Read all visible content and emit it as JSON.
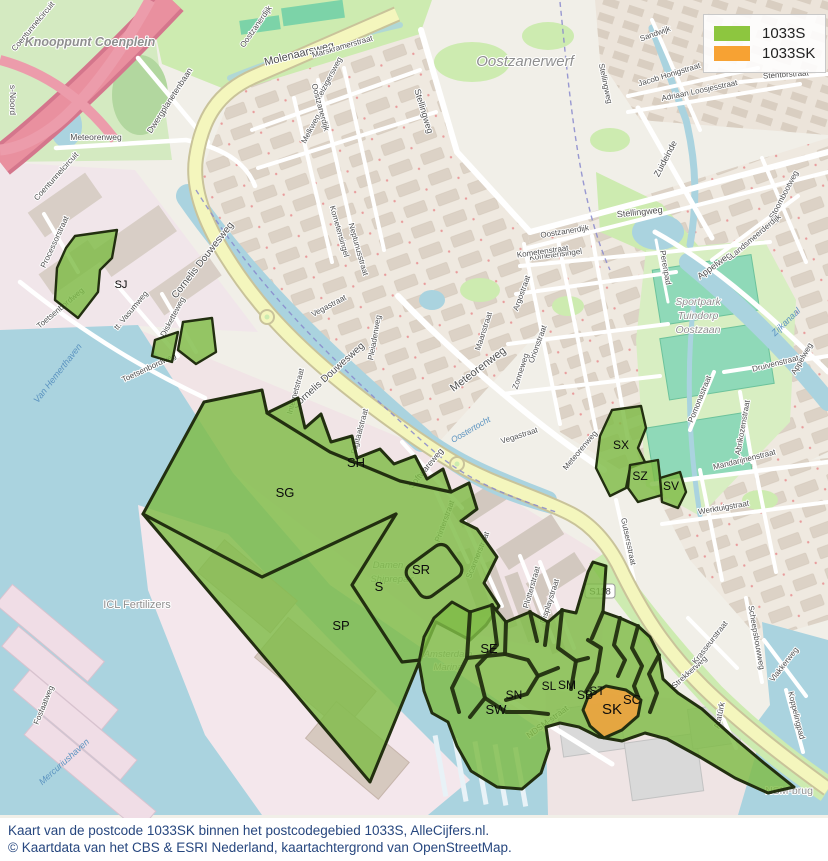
{
  "legend": {
    "items": [
      {
        "label": "1033S",
        "color": "#8dc63f"
      },
      {
        "label": "1033SK",
        "color": "#f7a233"
      }
    ]
  },
  "caption": {
    "line1": "Kaart van de postcode 1033SK binnen het postcodegebied 1033S, AlleCijfers.nl.",
    "line2": "© Kaartdata van het CBS & ESRI Nederland, kaartachtergrond van OpenStreetMap."
  },
  "map": {
    "colors": {
      "green": "#7fbc47",
      "orange": "#eda43f",
      "outline": "#222f10",
      "water": "#aad3df"
    },
    "shield": {
      "text": "S118"
    },
    "region_labels": [
      {
        "t": "SJ",
        "x": 121,
        "y": 288,
        "s": 11
      },
      {
        "t": "SG",
        "x": 285,
        "y": 497,
        "s": 13
      },
      {
        "t": "SH",
        "x": 356,
        "y": 467,
        "s": 13
      },
      {
        "t": "SP",
        "x": 341,
        "y": 630,
        "s": 13
      },
      {
        "t": "S",
        "x": 379,
        "y": 591,
        "s": 13
      },
      {
        "t": "SR",
        "x": 421,
        "y": 574,
        "s": 13
      },
      {
        "t": "SE",
        "x": 489,
        "y": 653,
        "s": 13
      },
      {
        "t": "SN",
        "x": 514,
        "y": 699,
        "s": 12
      },
      {
        "t": "SW",
        "x": 496,
        "y": 714,
        "s": 13
      },
      {
        "t": "SL",
        "x": 549,
        "y": 690,
        "s": 12
      },
      {
        "t": "SM",
        "x": 567,
        "y": 689,
        "s": 12
      },
      {
        "t": "SB",
        "x": 585,
        "y": 699,
        "s": 12
      },
      {
        "t": "ST",
        "x": 597,
        "y": 695,
        "s": 12
      },
      {
        "t": "SK",
        "x": 612,
        "y": 714,
        "s": 15
      },
      {
        "t": "SC",
        "x": 632,
        "y": 704,
        "s": 13
      },
      {
        "t": "SX",
        "x": 621,
        "y": 449,
        "s": 12
      },
      {
        "t": "SZ",
        "x": 640,
        "y": 480,
        "s": 12
      },
      {
        "t": "SV",
        "x": 671,
        "y": 490,
        "s": 12
      }
    ],
    "street_labels": [
      {
        "t": "Molenaarsweg",
        "x": 300,
        "y": 57,
        "r": -14,
        "s": 11
      },
      {
        "t": "Marskramerstraat",
        "x": 343,
        "y": 49,
        "r": -16,
        "s": 8
      },
      {
        "t": "Reizigersweg",
        "x": 331,
        "y": 80,
        "r": -62,
        "s": 8
      },
      {
        "t": "Melkweg",
        "x": 313,
        "y": 130,
        "r": -62,
        "s": 8
      },
      {
        "t": "Oostzanerdijk",
        "x": 258,
        "y": 28,
        "r": -55,
        "s": 8
      },
      {
        "t": "Oostzanerdijk",
        "x": 318,
        "y": 108,
        "r": 75,
        "s": 8
      },
      {
        "t": "Oostzanerdijk",
        "x": 565,
        "y": 234,
        "r": -9,
        "s": 8
      },
      {
        "t": "Stellingweg",
        "x": 421,
        "y": 112,
        "r": 73,
        "s": 9
      },
      {
        "t": "Stellingweg",
        "x": 640,
        "y": 215,
        "r": -6,
        "s": 9
      },
      {
        "t": "Stellingweg",
        "x": 603,
        "y": 84,
        "r": 78,
        "s": 8
      },
      {
        "t": "Kometensingel",
        "x": 556,
        "y": 257,
        "r": -7,
        "s": 8
      },
      {
        "t": "Kometensingel",
        "x": 337,
        "y": 232,
        "r": 74,
        "s": 8
      },
      {
        "t": "Neptunusstraat",
        "x": 356,
        "y": 250,
        "r": 74,
        "s": 8
      },
      {
        "t": "Kometenstraat",
        "x": 543,
        "y": 254,
        "r": -8,
        "s": 8
      },
      {
        "t": "Argostraat",
        "x": 524,
        "y": 294,
        "r": -70,
        "s": 8
      },
      {
        "t": "Maanstraat",
        "x": 486,
        "y": 332,
        "r": -72,
        "s": 8
      },
      {
        "t": "Orionstraat",
        "x": 540,
        "y": 345,
        "r": -70,
        "s": 8
      },
      {
        "t": "Zonneweg",
        "x": 523,
        "y": 372,
        "r": -72,
        "s": 8
      },
      {
        "t": "Vegastraat",
        "x": 330,
        "y": 308,
        "r": -28,
        "s": 8
      },
      {
        "t": "Vegastraat",
        "x": 520,
        "y": 438,
        "r": -18,
        "s": 8
      },
      {
        "t": "Pleiadenweg",
        "x": 377,
        "y": 338,
        "r": -80,
        "s": 8
      },
      {
        "t": "Meteorenweg",
        "x": 480,
        "y": 372,
        "r": -37,
        "s": 11
      },
      {
        "t": "Meteorenweg",
        "x": 582,
        "y": 452,
        "r": -50,
        "s": 8
      },
      {
        "t": "Meteorenweg",
        "x": 96,
        "y": 140,
        "r": 0,
        "s": 8.5
      },
      {
        "t": "Cornelis Douwesweg",
        "x": 205,
        "y": 262,
        "r": -52,
        "s": 10
      },
      {
        "t": "Cornelis Douwesweg",
        "x": 330,
        "y": 378,
        "r": -42,
        "s": 10
      },
      {
        "t": "Internetstraat",
        "x": 298,
        "y": 392,
        "r": -75,
        "s": 8
      },
      {
        "t": "Digitaalstraat",
        "x": 362,
        "y": 432,
        "r": -75,
        "s": 8
      },
      {
        "t": "Softwareweg",
        "x": 428,
        "y": 470,
        "r": -50,
        "s": 8.5
      },
      {
        "t": "Printerstraat",
        "x": 447,
        "y": 522,
        "r": -70,
        "s": 8
      },
      {
        "t": "Scannerstraat",
        "x": 480,
        "y": 556,
        "r": -68,
        "s": 8
      },
      {
        "t": "Plotterstraat",
        "x": 534,
        "y": 588,
        "r": -74,
        "s": 8
      },
      {
        "t": "Displaystraat",
        "x": 552,
        "y": 602,
        "r": -72,
        "s": 8
      },
      {
        "t": "Gutsersstraat",
        "x": 626,
        "y": 542,
        "r": 78,
        "s": 8
      },
      {
        "t": "Processorstraat",
        "x": 57,
        "y": 243,
        "r": -65,
        "s": 8
      },
      {
        "t": "Toetsenbordweg",
        "x": 62,
        "y": 310,
        "r": -40,
        "s": 8
      },
      {
        "t": "Toetsenbordweg",
        "x": 150,
        "y": 370,
        "r": -25,
        "s": 8
      },
      {
        "t": "tt. Vasumweg",
        "x": 133,
        "y": 312,
        "r": -50,
        "s": 8
      },
      {
        "t": "Disketteweg",
        "x": 175,
        "y": 318,
        "r": -62,
        "s": 8
      },
      {
        "t": "Fosfaatweg",
        "x": 46,
        "y": 706,
        "r": -68,
        "s": 8
      },
      {
        "t": "NDSM-straat",
        "x": 549,
        "y": 724,
        "r": -36,
        "s": 8.5
      },
      {
        "t": "Atatürk",
        "x": 722,
        "y": 716,
        "r": -78,
        "s": 8.5
      },
      {
        "t": "Strekkerweg",
        "x": 691,
        "y": 674,
        "r": -42,
        "s": 8
      },
      {
        "t": "Krasseurstraat",
        "x": 712,
        "y": 644,
        "r": -52,
        "s": 8
      },
      {
        "t": "Scheepsbouwweg",
        "x": 754,
        "y": 638,
        "r": 80,
        "s": 8
      },
      {
        "t": "Vlakkerweg",
        "x": 786,
        "y": 666,
        "r": -52,
        "s": 8
      },
      {
        "t": "Koppelingpad",
        "x": 794,
        "y": 716,
        "r": 76,
        "s": 8
      },
      {
        "t": "Mandarijnenstraat",
        "x": 745,
        "y": 462,
        "r": -14,
        "s": 8
      },
      {
        "t": "Werktuigstraat",
        "x": 724,
        "y": 510,
        "r": -10,
        "s": 8
      },
      {
        "t": "Pomonastraat",
        "x": 702,
        "y": 400,
        "r": -68,
        "s": 8
      },
      {
        "t": "Druivenstraat",
        "x": 776,
        "y": 366,
        "r": -14,
        "s": 8
      },
      {
        "t": "Abrikozenstraat",
        "x": 745,
        "y": 428,
        "r": -80,
        "s": 8
      },
      {
        "t": "Appelweg",
        "x": 716,
        "y": 268,
        "r": -36,
        "s": 9
      },
      {
        "t": "Appelweg",
        "x": 804,
        "y": 360,
        "r": -60,
        "s": 8
      },
      {
        "t": "Perenpad",
        "x": 663,
        "y": 268,
        "r": 80,
        "s": 8
      },
      {
        "t": "Zuideinde",
        "x": 668,
        "y": 160,
        "r": -62,
        "s": 9
      },
      {
        "t": "Stoombootweg",
        "x": 786,
        "y": 196,
        "r": -62,
        "s": 8
      },
      {
        "t": "Landsmeerderdijk",
        "x": 757,
        "y": 238,
        "r": -40,
        "s": 8
      },
      {
        "t": "Sandwijk",
        "x": 656,
        "y": 36,
        "r": -20,
        "s": 8
      },
      {
        "t": "Jacob Honigstraat",
        "x": 670,
        "y": 77,
        "r": -17,
        "s": 8
      },
      {
        "t": "Adriaan Loosjesstraat",
        "x": 700,
        "y": 93,
        "r": -12,
        "s": 8
      },
      {
        "t": "Stentorstraat",
        "x": 786,
        "y": 77,
        "r": -4,
        "s": 8
      },
      {
        "t": "Dwergplanetenbaan",
        "x": 172,
        "y": 102,
        "r": -57,
        "s": 8.5
      },
      {
        "t": "Coentunnelcircuit",
        "x": 35,
        "y": 28,
        "r": -50,
        "s": 8
      },
      {
        "t": "Coentunnelcircuit",
        "x": 58,
        "y": 178,
        "r": -48,
        "s": 8
      },
      {
        "t": "s-Noord",
        "x": 10,
        "y": 100,
        "r": 90,
        "s": 8.5
      }
    ],
    "water_labels": [
      {
        "t": "Van Hemerthaven",
        "x": 60,
        "y": 375,
        "r": -52,
        "s": 9
      },
      {
        "t": "Mercuriushaven",
        "x": 66,
        "y": 764,
        "r": -42,
        "s": 9
      },
      {
        "t": "Zijkanaal",
        "x": 788,
        "y": 324,
        "r": -44,
        "s": 9
      },
      {
        "t": "Oostertocht",
        "x": 472,
        "y": 432,
        "r": -30,
        "s": 8.5
      }
    ],
    "place_labels": [
      {
        "t": "Knooppunt Coenplein",
        "x": 90,
        "y": 46,
        "r": 0,
        "s": 12.5,
        "c": "#c0394f",
        "i": 1,
        "b": 1
      },
      {
        "t": "Oostzanerwerf",
        "x": 525,
        "y": 66,
        "r": 0,
        "s": 15,
        "c": "#8f8f8f",
        "i": 1
      },
      {
        "t": "Sportpark",
        "x": 698,
        "y": 305,
        "r": 0,
        "s": 10.5,
        "c": "#55a183",
        "i": 1
      },
      {
        "t": "Tuindorp",
        "x": 698,
        "y": 319,
        "r": 0,
        "s": 10.5,
        "c": "#55a183",
        "i": 1
      },
      {
        "t": "Oostzaan",
        "x": 698,
        "y": 333,
        "r": 0,
        "s": 10.5,
        "c": "#55a183",
        "i": 1
      },
      {
        "t": "ICL Fertilizers",
        "x": 137,
        "y": 608,
        "r": 0,
        "s": 11,
        "c": "#8a8a8a"
      },
      {
        "t": "Damen",
        "x": 388,
        "y": 568,
        "r": 0,
        "s": 9.5,
        "c": "#79b8aa",
        "i": 1
      },
      {
        "t": "Shiprepair",
        "x": 392,
        "y": 582,
        "r": 0,
        "s": 9.5,
        "c": "#79b8aa",
        "i": 1
      },
      {
        "t": "Amsterdam",
        "x": 448,
        "y": 657,
        "r": 0,
        "s": 9.5,
        "c": "#79b8aa",
        "i": 1
      },
      {
        "t": "Marina",
        "x": 448,
        "y": 670,
        "r": 0,
        "s": 9.5,
        "c": "#79b8aa",
        "i": 1
      },
      {
        "t": "NSM-brug",
        "x": 789,
        "y": 794,
        "r": 0,
        "s": 10.5,
        "c": "#333333"
      }
    ]
  }
}
